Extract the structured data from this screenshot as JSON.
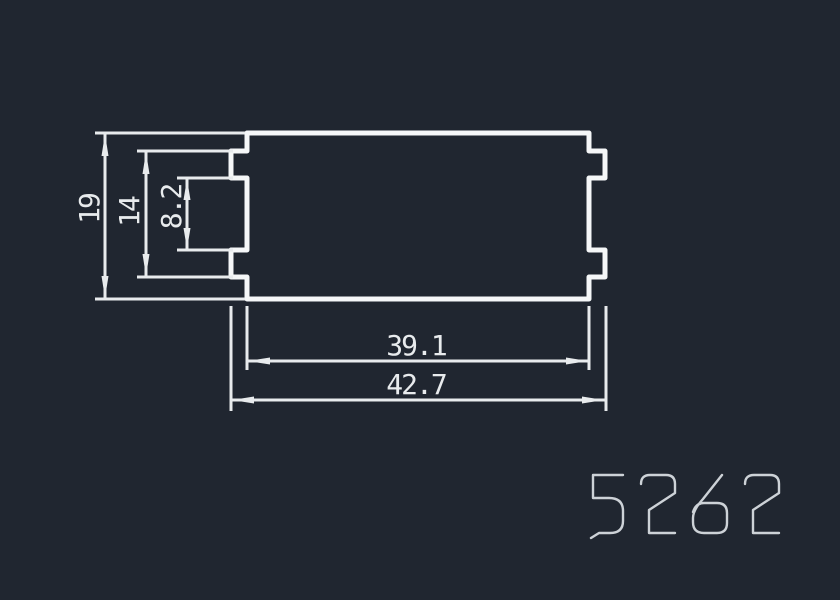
{
  "canvas": {
    "background_color": "#202630"
  },
  "colors": {
    "outline": "#f5f7f8",
    "dimension": "#e8ebed",
    "part_number": "#cdd2d7"
  },
  "drawing": {
    "dimensions": {
      "overall_height": "19",
      "tab_outer_height": "14",
      "tab_inner_gap": "8.2",
      "body_width": "39.1",
      "overall_width": "42.7"
    }
  },
  "part_number": {
    "text": "5262"
  }
}
